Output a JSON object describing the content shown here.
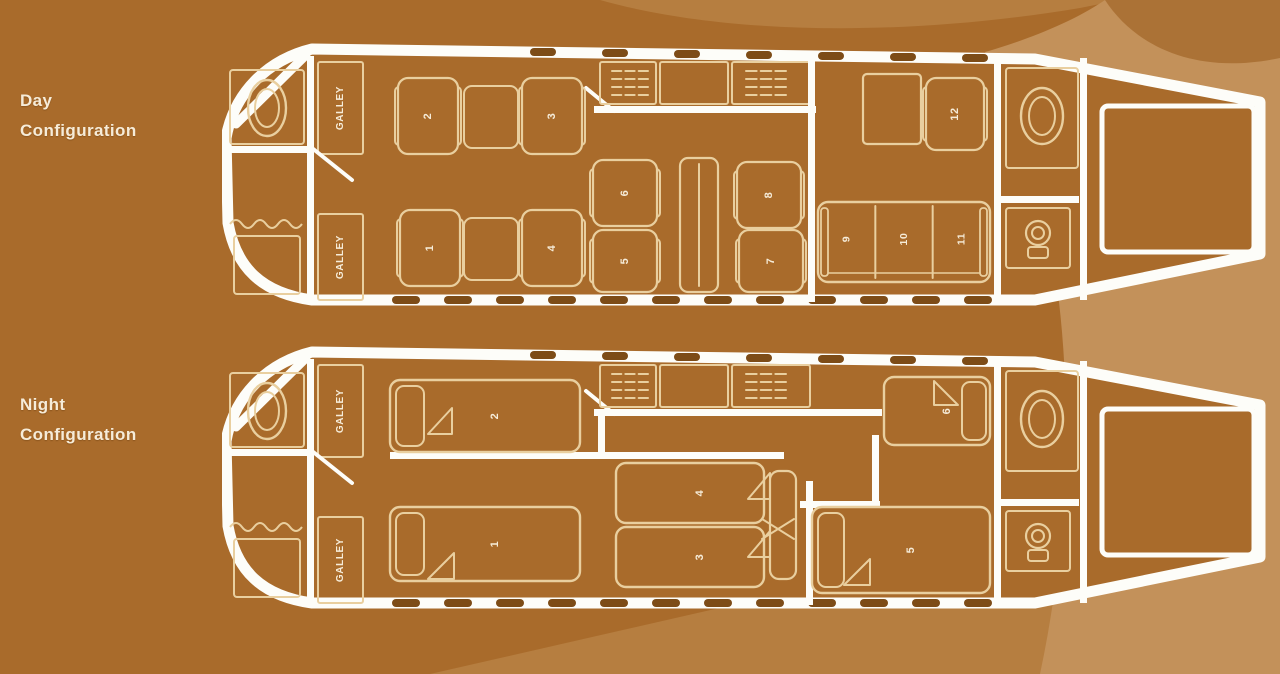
{
  "titles": {
    "day": [
      "Day",
      "Configuration"
    ],
    "night": [
      "Night",
      "Configuration"
    ]
  },
  "galley_label": "GALLEY",
  "day": {
    "forward_seats": [
      "2",
      "3",
      "1",
      "4"
    ],
    "club_seats": [
      "6",
      "5",
      "8",
      "7"
    ],
    "single_seat": "12",
    "divan_seats": [
      "9",
      "10",
      "11"
    ]
  },
  "night": {
    "beds": {
      "fwd_top": "2",
      "fwd_bottom": "1",
      "mid_top": "4",
      "mid_bottom": "3",
      "aft_top": "6",
      "aft_bottom": "5"
    }
  },
  "colors": {
    "background": "#a96b2b",
    "swoosh_light": "#c3915a",
    "swoosh_mid": "#b67e40",
    "swoosh_dark": "#ab7236",
    "fuselage_white": "#fdfdf9",
    "furniture_line": "#e9cf9f",
    "text_cream": "#f6ecd9",
    "window": "#7d4c17"
  }
}
